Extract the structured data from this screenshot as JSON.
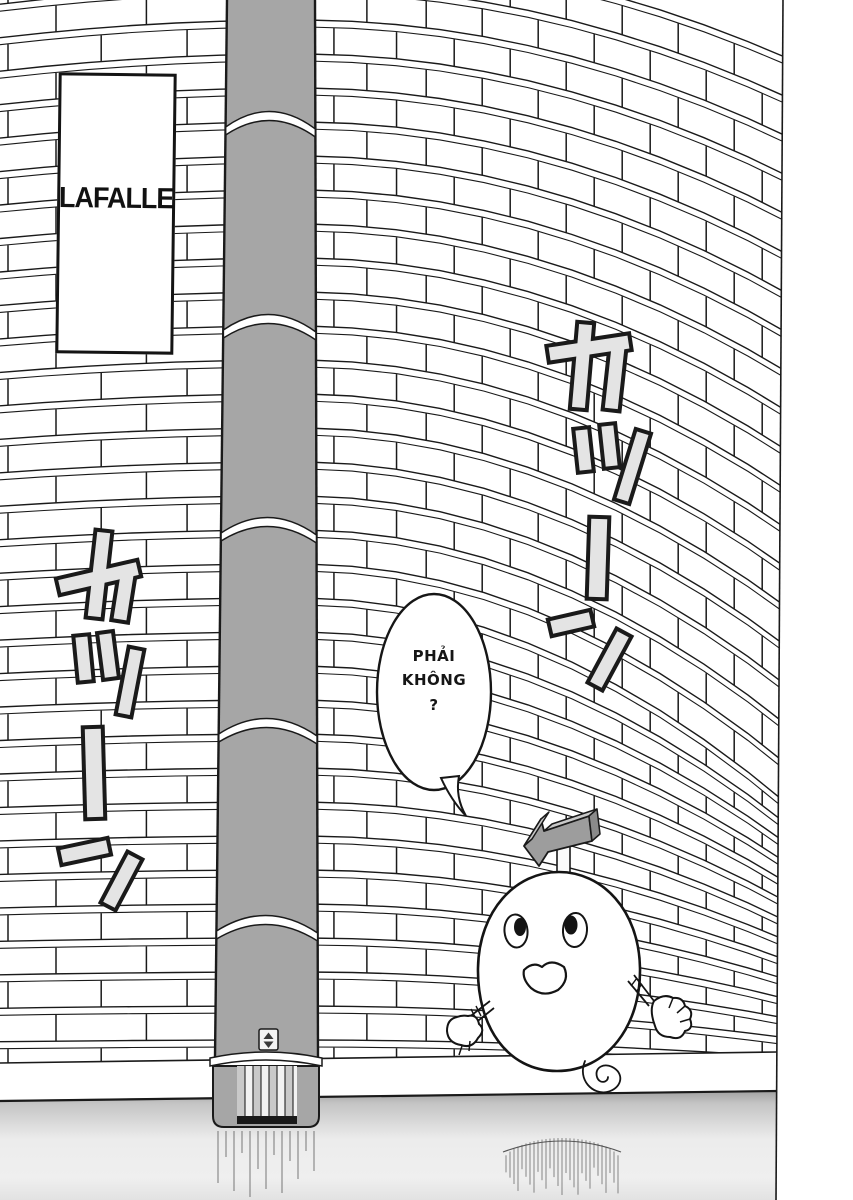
{
  "sign": {
    "text": "LAFALLE"
  },
  "speech_bubble": {
    "lines": [
      "PHẢI",
      "KHÔNG",
      "?"
    ]
  },
  "sfx_left": {
    "text": "カッーン"
  },
  "sfx_right": {
    "text": "カッーン"
  },
  "icons": {
    "head_arrow": "left-arrow-3d-icon",
    "pillar_plate": "up-down-arrows-icon"
  },
  "colors": {
    "ink": "#1a1a1a",
    "paper": "#ffffff",
    "pillar_gray": "#a6a6a6",
    "arrow_front": "#9d9d9d",
    "arrow_top": "#c9c9c9",
    "arrow_side": "#8a8a8a",
    "sfx_fill": "#e4e4e4",
    "floor_top": "#9e9e9e",
    "floor_light": "#ececec"
  }
}
